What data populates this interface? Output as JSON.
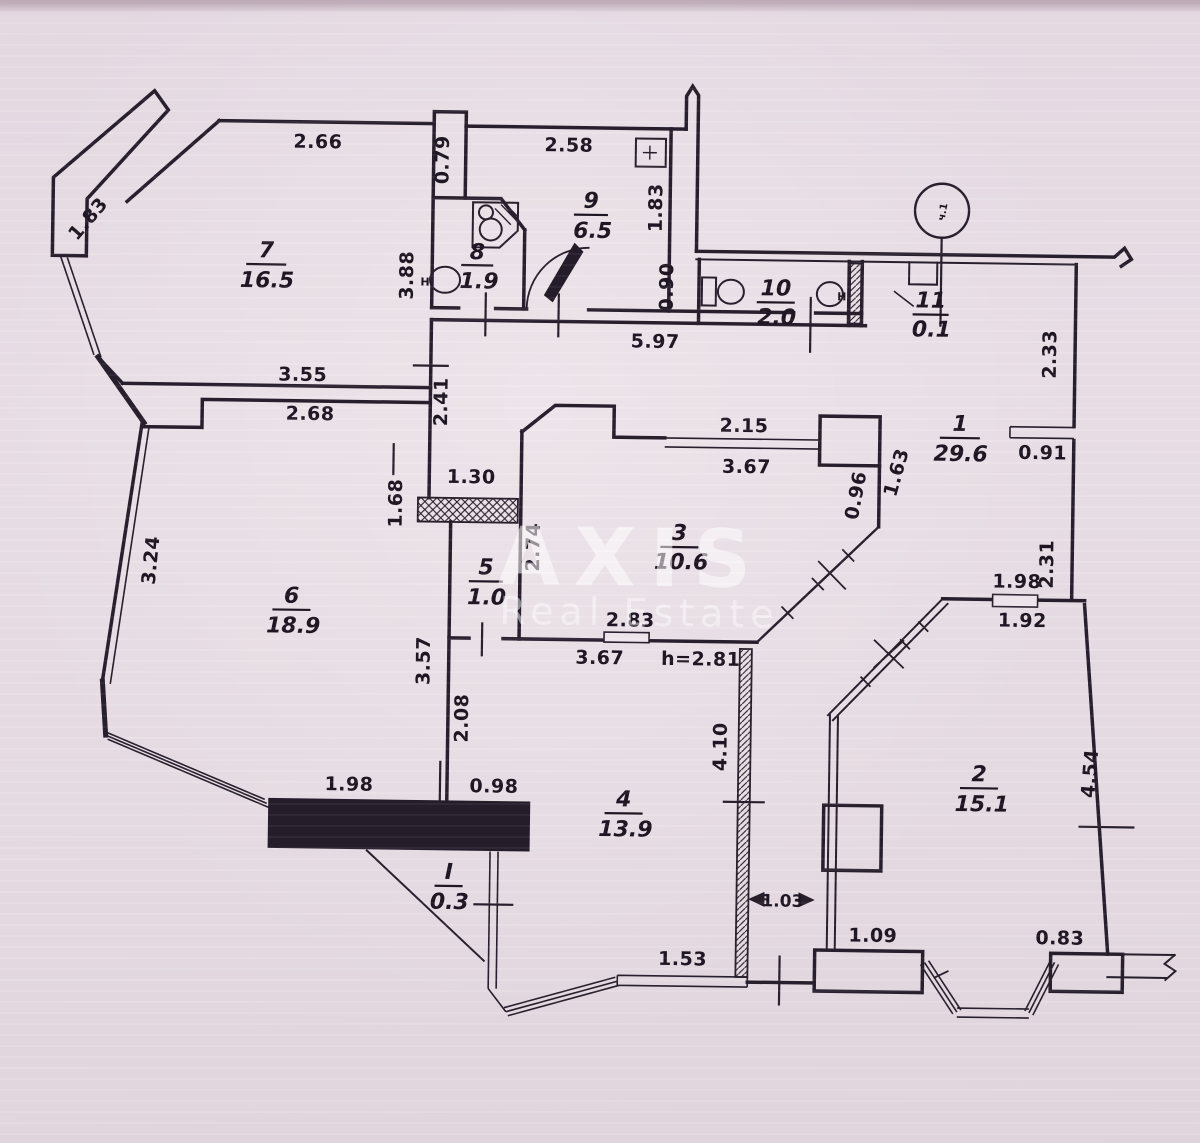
{
  "watermark": {
    "line1": "AXIS",
    "line2": "Real Estate"
  },
  "rooms": [
    {
      "num": "7",
      "area": "16.5"
    },
    {
      "num": "8",
      "area": "1.9"
    },
    {
      "num": "9",
      "area": "6.5"
    },
    {
      "num": "10",
      "area": "2.0"
    },
    {
      "num": "11",
      "area": "0.1"
    },
    {
      "num": "1",
      "area": "29.6"
    },
    {
      "num": "2",
      "area": "15.1"
    },
    {
      "num": "3",
      "area": "10.6"
    },
    {
      "num": "4",
      "area": "13.9"
    },
    {
      "num": "5",
      "area": "1.0"
    },
    {
      "num": "6",
      "area": "18.9"
    },
    {
      "num": "I",
      "area": "0.3"
    }
  ],
  "dims": {
    "d266": "2.66",
    "d079": "0.79",
    "d258": "2.58",
    "d183a": "1.83",
    "d183b": "1.83",
    "d388": "3.88",
    "d090": "0.90",
    "d597": "5.97",
    "d233": "2.33",
    "d091": "0.91",
    "d231": "2.31",
    "d355": "3.55",
    "d268": "2.68",
    "d241": "2.41",
    "d130": "1.30",
    "d168": "1.68",
    "d215": "2.15",
    "d367a": "3.67",
    "d096": "0.96",
    "d163": "1.63",
    "d274": "2.74",
    "d283": "2.83",
    "d367b": "3.67",
    "h281": "h=2.81",
    "d324": "3.24",
    "d357": "3.57",
    "d208": "2.08",
    "d410": "4.10",
    "d198a": "1.98",
    "d192": "1.92",
    "d198b": "1.98",
    "d098": "0.98",
    "d153": "1.53",
    "d103": "1.03",
    "d109": "1.09",
    "d083": "0.83",
    "d454": "4.54"
  },
  "symbols": {
    "circle_mark": "ч.1",
    "sink": "H"
  }
}
